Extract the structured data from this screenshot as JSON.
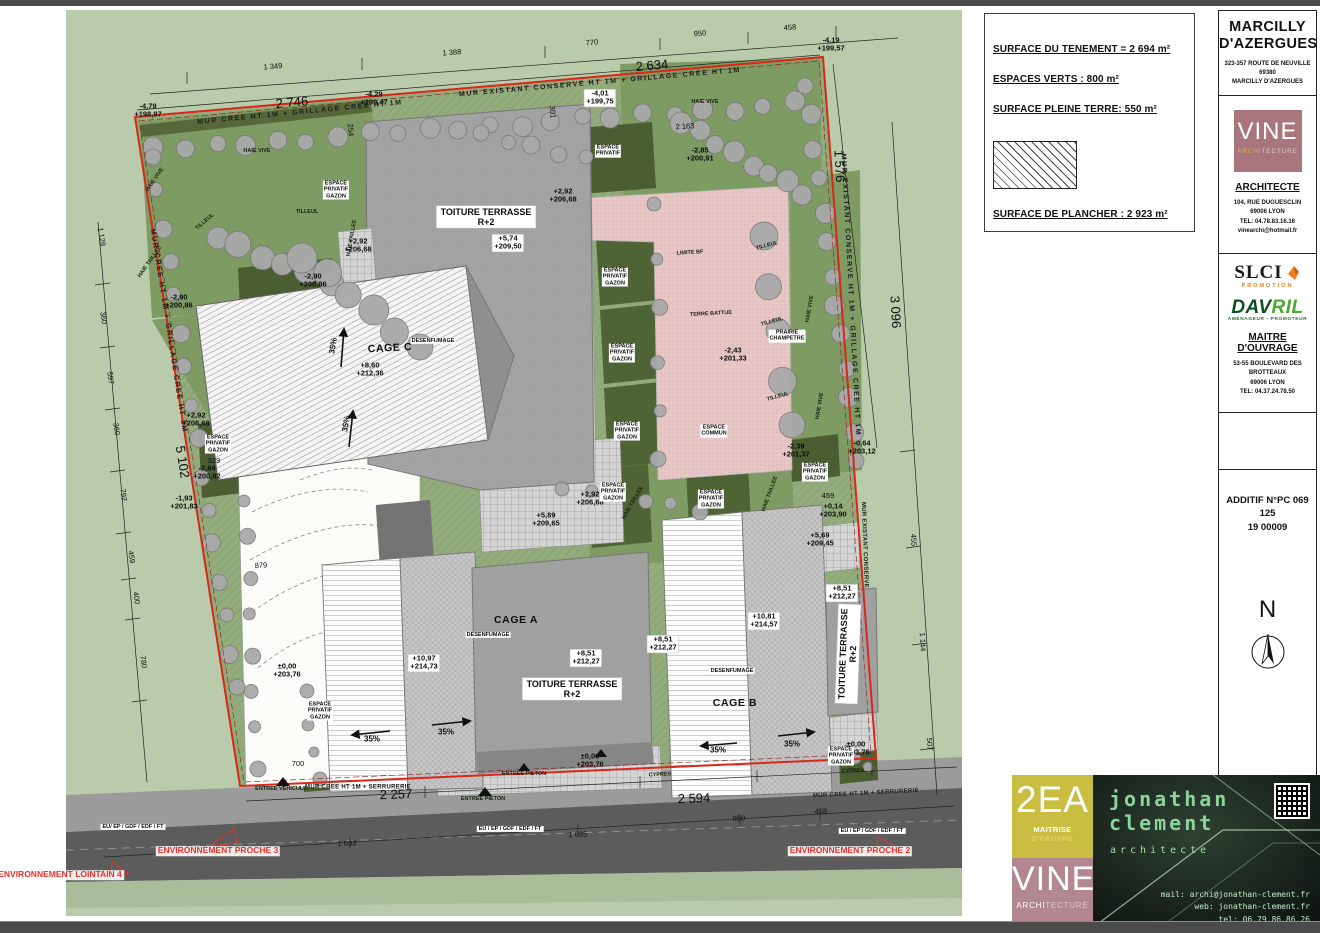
{
  "legend": {
    "tenement": "SURFACE DU TENEMENT = 2 694 m²",
    "espaces_verts": "ESPACES VERTS : 800 m²",
    "pleine_terre": "SURFACE PLEINE TERRE: 550 m²",
    "plancher": "SURFACE DE PLANCHER : 2 923 m²"
  },
  "titleblock": {
    "city_line1": "MARCILLY",
    "city_line2": "D'AZERGUES",
    "address": "323-357 ROUTE DE NEUVILLE\n69380\nMARCILLY D'AZERGUES",
    "vine": {
      "name": "VINE",
      "archi": "ARCHI",
      "tecture": "TECTURE"
    },
    "architecte": "ARCHITECTE",
    "architecte_info": "104, RUE DUGUESCLIN\n69006  LYON\nTEL: 04.78.83.16.16\nvinearchi@hotmail.fr",
    "slci": {
      "name": "SLCI",
      "sub": "PROMOTION"
    },
    "davril": {
      "name_a": "DAV",
      "name_b": "RIL",
      "sub": "AMÉNAGEUR - PROMOTEUR"
    },
    "maitre": "MAITRE D'OUVRAGE",
    "maitre_info": "53-55 BOULEVARD DES\nBROTTEAUX\n69006  LYON\nTEL: 04.37.24.78.50",
    "additif": "ADDITIF N°PC 069 125\n19 00009",
    "north": "N"
  },
  "footer": {
    "ea": {
      "name": "2EA",
      "sub1": "MAITRISE",
      "sub2": " D'OEUVRE"
    },
    "vine": {
      "name": "VINE",
      "sub1": "ARCHI",
      "sub2": "TECTURE"
    },
    "jc": {
      "first": "jonathan",
      "last": "clement",
      "role": "architecte",
      "mail": "mail: archi@jonathan-clement.fr",
      "web": "web: jonathan-clement.fr",
      "tel": "tel: 06.79.86.86.26"
    }
  },
  "colors": {
    "boundary_red": "#d8281a",
    "label_red": "#e8312a",
    "field_green": "#b9cbaa",
    "garden_green": "#7e9b63",
    "hedge_dark_green": "#47582d",
    "terre_battue_pink": "#e7c7c6",
    "vine_mauve": "#a8767c",
    "ea_yellow": "#c9bd42",
    "footer_vine_rose": "#b28790",
    "slci_orange": "#ef7d1a",
    "davril_green": "#2f8d3a",
    "jc_green": "#8ed49a",
    "road_gray": "#5c5c5c"
  },
  "plan": {
    "labels": [
      {
        "t": "1 349",
        "x": 273,
        "y": 67,
        "r": -4,
        "c": "dim"
      },
      {
        "t": "1 388",
        "x": 452,
        "y": 53,
        "r": -4,
        "c": "dim"
      },
      {
        "t": "770",
        "x": 592,
        "y": 43,
        "r": -4,
        "c": "dim"
      },
      {
        "t": "950",
        "x": 700,
        "y": 34,
        "r": -4,
        "c": "dim"
      },
      {
        "t": "458",
        "x": 790,
        "y": 28,
        "r": -4,
        "c": "dim"
      },
      {
        "t": "2 746",
        "x": 292,
        "y": 103,
        "r": -5,
        "c": "dimBig"
      },
      {
        "t": "2 634",
        "x": 652,
        "y": 66,
        "r": -5,
        "c": "dimBig"
      },
      {
        "t": "2 163",
        "x": 685,
        "y": 127,
        "r": -3,
        "c": "dim"
      },
      {
        "t": "301",
        "x": 552,
        "y": 112,
        "r": 85,
        "c": "dim"
      },
      {
        "t": "254",
        "x": 350,
        "y": 130,
        "r": 85,
        "c": "dim"
      },
      {
        "t": "1 128",
        "x": 101,
        "y": 237,
        "r": 81,
        "c": "dim"
      },
      {
        "t": "360",
        "x": 103,
        "y": 318,
        "r": 81,
        "c": "dim"
      },
      {
        "t": "597",
        "x": 110,
        "y": 378,
        "r": 81,
        "c": "dim"
      },
      {
        "t": "360",
        "x": 116,
        "y": 429,
        "r": 81,
        "c": "dim"
      },
      {
        "t": "792",
        "x": 123,
        "y": 495,
        "r": 81,
        "c": "dim"
      },
      {
        "t": "459",
        "x": 131,
        "y": 557,
        "r": 81,
        "c": "dim"
      },
      {
        "t": "400",
        "x": 136,
        "y": 598,
        "r": 81,
        "c": "dim"
      },
      {
        "t": "780",
        "x": 143,
        "y": 662,
        "r": 81,
        "c": "dim"
      },
      {
        "t": "5 102",
        "x": 182,
        "y": 462,
        "r": 81,
        "c": "dimBig"
      },
      {
        "t": "700",
        "x": 298,
        "y": 764,
        "c": "dim"
      },
      {
        "t": "879",
        "x": 261,
        "y": 566,
        "r": -3,
        "c": "dim"
      },
      {
        "t": "1 576",
        "x": 839,
        "y": 166,
        "r": 87,
        "c": "dimBig"
      },
      {
        "t": "3 096",
        "x": 895,
        "y": 312,
        "r": 87,
        "c": "dimBig"
      },
      {
        "t": "455",
        "x": 913,
        "y": 540,
        "r": 87,
        "c": "dim"
      },
      {
        "t": "1 144",
        "x": 922,
        "y": 642,
        "r": 87,
        "c": "dim"
      },
      {
        "t": "507",
        "x": 929,
        "y": 744,
        "r": 87,
        "c": "dim"
      },
      {
        "t": "459",
        "x": 828,
        "y": 496,
        "c": "dim"
      },
      {
        "t": "2 257",
        "x": 396,
        "y": 795,
        "r": -2,
        "c": "dimBig"
      },
      {
        "t": "2 594",
        "x": 694,
        "y": 799,
        "r": -2,
        "c": "dimBig"
      },
      {
        "t": "950",
        "x": 739,
        "y": 819,
        "r": -2,
        "c": "dim"
      },
      {
        "t": "458",
        "x": 821,
        "y": 812,
        "r": -2,
        "c": "dim"
      },
      {
        "t": "1 685",
        "x": 578,
        "y": 835,
        "r": -2,
        "c": "dim"
      },
      {
        "t": "1 033",
        "x": 347,
        "y": 844,
        "r": -2,
        "c": "dim"
      },
      {
        "t": "-4,79\n+198,97",
        "x": 148,
        "y": 111,
        "c": "elev"
      },
      {
        "t": "-4,29\n+199,47",
        "x": 374,
        "y": 99,
        "c": "elev"
      },
      {
        "t": "-4,01\n+199,75",
        "x": 600,
        "y": 98,
        "c": "elevBox"
      },
      {
        "t": "-4,19\n+199,57",
        "x": 831,
        "y": 45,
        "c": "elev"
      },
      {
        "t": "-2,85\n+200,91",
        "x": 700,
        "y": 155,
        "c": "elev"
      },
      {
        "t": "+2,92\n+206,68",
        "x": 563,
        "y": 196,
        "c": "elev"
      },
      {
        "t": "+2,92\n+206,68",
        "x": 358,
        "y": 246,
        "c": "elev"
      },
      {
        "t": "+5,74\n+209,50",
        "x": 508,
        "y": 243,
        "c": "elevBox"
      },
      {
        "t": "-2,90\n+200,86",
        "x": 179,
        "y": 302,
        "c": "elev"
      },
      {
        "t": "-2,90\n+200,86",
        "x": 313,
        "y": 281,
        "c": "elev"
      },
      {
        "t": "+8,60\n+212,36",
        "x": 370,
        "y": 370,
        "c": "elev"
      },
      {
        "t": "+2,92\n+206,68",
        "x": 196,
        "y": 420,
        "c": "elev"
      },
      {
        "t": "329",
        "x": 214,
        "y": 461,
        "c": "dim"
      },
      {
        "t": "-2,84\n+200,92",
        "x": 207,
        "y": 473,
        "c": "elev"
      },
      {
        "t": "-1,93\n+201,83",
        "x": 184,
        "y": 503,
        "c": "elev"
      },
      {
        "t": "-2,43\n+201,33",
        "x": 733,
        "y": 355,
        "c": "elev"
      },
      {
        "t": "-2,39\n+201,37",
        "x": 796,
        "y": 451,
        "c": "elev"
      },
      {
        "t": "-0,64\n+203,12",
        "x": 862,
        "y": 448,
        "c": "elev"
      },
      {
        "t": "+0,14\n+203,90",
        "x": 833,
        "y": 511,
        "c": "elev"
      },
      {
        "t": "+5,69\n+209,45",
        "x": 820,
        "y": 540,
        "c": "elev"
      },
      {
        "t": "+5,89\n+209,65",
        "x": 546,
        "y": 520,
        "c": "elev"
      },
      {
        "t": "+2,92\n+206,68",
        "x": 590,
        "y": 499,
        "c": "elev"
      },
      {
        "t": "+8,51\n+212,27",
        "x": 842,
        "y": 593,
        "c": "elevBox"
      },
      {
        "t": "+8,51\n+212,27",
        "x": 586,
        "y": 658,
        "c": "elevBox"
      },
      {
        "t": "+8,51\n+212,27",
        "x": 663,
        "y": 644,
        "c": "elevBox"
      },
      {
        "t": "+10,81\n+214,57",
        "x": 764,
        "y": 621,
        "c": "elevBox"
      },
      {
        "t": "+10,97\n+214,73",
        "x": 424,
        "y": 663,
        "c": "elevBox"
      },
      {
        "t": "±0,00\n+203,76",
        "x": 287,
        "y": 671,
        "c": "elev"
      },
      {
        "t": "±0,00\n+203,76",
        "x": 590,
        "y": 761,
        "c": "elev"
      },
      {
        "t": "±0,00\n+203,76",
        "x": 856,
        "y": 749,
        "c": "elev"
      },
      {
        "t": "CAGE C",
        "x": 390,
        "y": 349,
        "r": -3,
        "c": "name"
      },
      {
        "t": "CAGE A",
        "x": 516,
        "y": 621,
        "c": "name"
      },
      {
        "t": "CAGE B",
        "x": 735,
        "y": 704,
        "c": "name"
      },
      {
        "t": "TOITURE TERRASSE\nR+2",
        "x": 486,
        "y": 217,
        "c": "nameBox"
      },
      {
        "t": "TOITURE TERRASSE\nR+2",
        "x": 572,
        "y": 689,
        "c": "nameBox"
      },
      {
        "t": "TOITURE TERRASSE\nR+2",
        "x": 848,
        "y": 654,
        "r": -88,
        "c": "nameBox"
      },
      {
        "t": "MUR CREE HT 1M + GRILLAGE CREE HT 1M",
        "x": 300,
        "y": 113,
        "r": -5.5,
        "c": "wallWide"
      },
      {
        "t": "MUR EXISTANT CONSERVE HT 1M + GRILLAGE CREE HT 1M",
        "x": 600,
        "y": 83,
        "r": -5,
        "c": "wallWide"
      },
      {
        "t": "MUR CREE HT 1M + GRILLAGE CREE HT 1M",
        "x": 168,
        "y": 331,
        "r": 81,
        "c": "wallWide"
      },
      {
        "t": "MUR EXISTANT CONSERVE HT 1M + GRILLAGE CREE HT 1M",
        "x": 850,
        "y": 295,
        "r": 87,
        "c": "wallWide"
      },
      {
        "t": "MUR EXISTANT CONSERVE",
        "x": 864,
        "y": 545,
        "r": 88,
        "c": "wall"
      },
      {
        "t": "MUR CREE HT 1M + SERRURERIE",
        "x": 358,
        "y": 788,
        "c": "wall"
      },
      {
        "t": "MUR CREE HT 1M + SERRURERIE",
        "x": 866,
        "y": 794,
        "r": -3,
        "c": "wall"
      },
      {
        "t": "LIMITE BF",
        "x": 690,
        "y": 253,
        "r": -3,
        "c": "tinyDark"
      },
      {
        "t": "ESPACE\nPRIVATIF\nGAZON",
        "x": 336,
        "y": 190,
        "c": "tiny"
      },
      {
        "t": "ESPACE\nPRIVATIF\nGAZON",
        "x": 615,
        "y": 277,
        "c": "tiny"
      },
      {
        "t": "ESPACE\nPRIVATIF\nGAZON",
        "x": 622,
        "y": 353,
        "c": "tiny"
      },
      {
        "t": "ESPACE\nPRIVATIF\nGAZON",
        "x": 627,
        "y": 431,
        "c": "tiny"
      },
      {
        "t": "ESPACE\nPRIVATIF\nGAZON",
        "x": 613,
        "y": 492,
        "c": "tiny"
      },
      {
        "t": "ESPACE\nPRIVATIF\nGAZON",
        "x": 711,
        "y": 499,
        "c": "tiny"
      },
      {
        "t": "ESPACE\nPRIVATIF\nGAZON",
        "x": 815,
        "y": 472,
        "c": "tiny"
      },
      {
        "t": "ESPACE\nPRIVATIF\nGAZON",
        "x": 218,
        "y": 444,
        "c": "tiny"
      },
      {
        "t": "ESPACE\nPRIVATIF\nGAZON",
        "x": 320,
        "y": 711,
        "c": "tiny"
      },
      {
        "t": "ESPACE\nPRIVATIF\nGAZON",
        "x": 841,
        "y": 756,
        "c": "tiny"
      },
      {
        "t": "ESPACE\nPRIVATIF",
        "x": 608,
        "y": 151,
        "c": "tiny"
      },
      {
        "t": "ESPACE\nCOMMUN",
        "x": 714,
        "y": 431,
        "c": "tiny"
      },
      {
        "t": "TERRE BATTUE",
        "x": 711,
        "y": 314,
        "r": -3,
        "c": "tinyDark"
      },
      {
        "t": "PRAIRIE\nCHAMPETRE",
        "x": 787,
        "y": 336,
        "c": "tiny"
      },
      {
        "t": "CYPRES",
        "x": 660,
        "y": 775,
        "r": -3,
        "c": "tinyDark"
      },
      {
        "t": "CYPRES",
        "x": 853,
        "y": 771,
        "r": -3,
        "c": "tinyDark"
      },
      {
        "t": "DESENFUMAGE",
        "x": 433,
        "y": 341,
        "c": "tiny"
      },
      {
        "t": "DESENFUMAGE",
        "x": 488,
        "y": 635,
        "c": "tiny"
      },
      {
        "t": "DESENFUMAGE",
        "x": 732,
        "y": 671,
        "c": "tiny"
      },
      {
        "t": "TILLEUL",
        "x": 205,
        "y": 222,
        "r": -40,
        "c": "tinyDark"
      },
      {
        "t": "TILLEUL",
        "x": 307,
        "y": 212,
        "c": "tinyDark"
      },
      {
        "t": "TILLEUL",
        "x": 767,
        "y": 246,
        "r": -15,
        "c": "tinyDark"
      },
      {
        "t": "TILLEUL",
        "x": 772,
        "y": 322,
        "r": -15,
        "c": "tinyDark"
      },
      {
        "t": "TILLEUL",
        "x": 778,
        "y": 397,
        "r": -15,
        "c": "tinyDark"
      },
      {
        "t": "HAIE VIVE",
        "x": 257,
        "y": 151,
        "c": "tinyDark"
      },
      {
        "t": "HAIE VIVE",
        "x": 705,
        "y": 102,
        "c": "tinyDark"
      },
      {
        "t": "HAIE VIVE",
        "x": 810,
        "y": 309,
        "r": -80,
        "c": "tinyDark"
      },
      {
        "t": "HAIE VIVE",
        "x": 820,
        "y": 406,
        "r": -80,
        "c": "tinyDark"
      },
      {
        "t": "HAIE VIVE",
        "x": 155,
        "y": 180,
        "r": -55,
        "c": "tinyDark"
      },
      {
        "t": "HAIE TAILLEE",
        "x": 352,
        "y": 238,
        "r": -80,
        "c": "tinyDark"
      },
      {
        "t": "HAIE TAILLEE",
        "x": 633,
        "y": 503,
        "r": -60,
        "c": "tinyDark"
      },
      {
        "t": "HAIE TAILLEE",
        "x": 770,
        "y": 494,
        "r": -70,
        "c": "tinyDark"
      },
      {
        "t": "HAIE TAILLEE",
        "x": 150,
        "y": 262,
        "r": -55,
        "c": "tinyDark"
      },
      {
        "t": "EU/ EP / GDF / EDF / FT",
        "x": 133,
        "y": 827,
        "c": "road"
      },
      {
        "t": "EU / EP / GDF / EDF / FT",
        "x": 510,
        "y": 829,
        "c": "road"
      },
      {
        "t": "EU / EP / GDF / EDF / FT",
        "x": 872,
        "y": 831,
        "c": "road"
      },
      {
        "t": "ENTREE VEHICULE",
        "x": 281,
        "y": 789,
        "c": "tinyDark"
      },
      {
        "t": "ENTREE PIETON",
        "x": 483,
        "y": 799,
        "c": "tinyDark"
      },
      {
        "t": "ENTREE PIETON",
        "x": 524,
        "y": 774,
        "c": "tinyDark"
      },
      {
        "t": "ENVIRONNEMENT PROCHE 3",
        "x": 218,
        "y": 851,
        "c": "red"
      },
      {
        "t": "ENVIRONNEMENT PROCHE 2",
        "x": 850,
        "y": 851,
        "c": "red"
      },
      {
        "t": "ENVIRONNEMENT LOINTAIN 4",
        "x": 60,
        "y": 875,
        "c": "red"
      },
      {
        "t": "35%",
        "x": 334,
        "y": 346,
        "r": -80,
        "c": "slope"
      },
      {
        "t": "35%",
        "x": 347,
        "y": 424,
        "r": -80,
        "c": "slope"
      },
      {
        "t": "35%",
        "x": 372,
        "y": 740,
        "c": "slope"
      },
      {
        "t": "35%",
        "x": 446,
        "y": 733,
        "c": "slope"
      },
      {
        "t": "35%",
        "x": 718,
        "y": 751,
        "c": "slope"
      },
      {
        "t": "35%",
        "x": 792,
        "y": 745,
        "c": "slope"
      }
    ]
  }
}
